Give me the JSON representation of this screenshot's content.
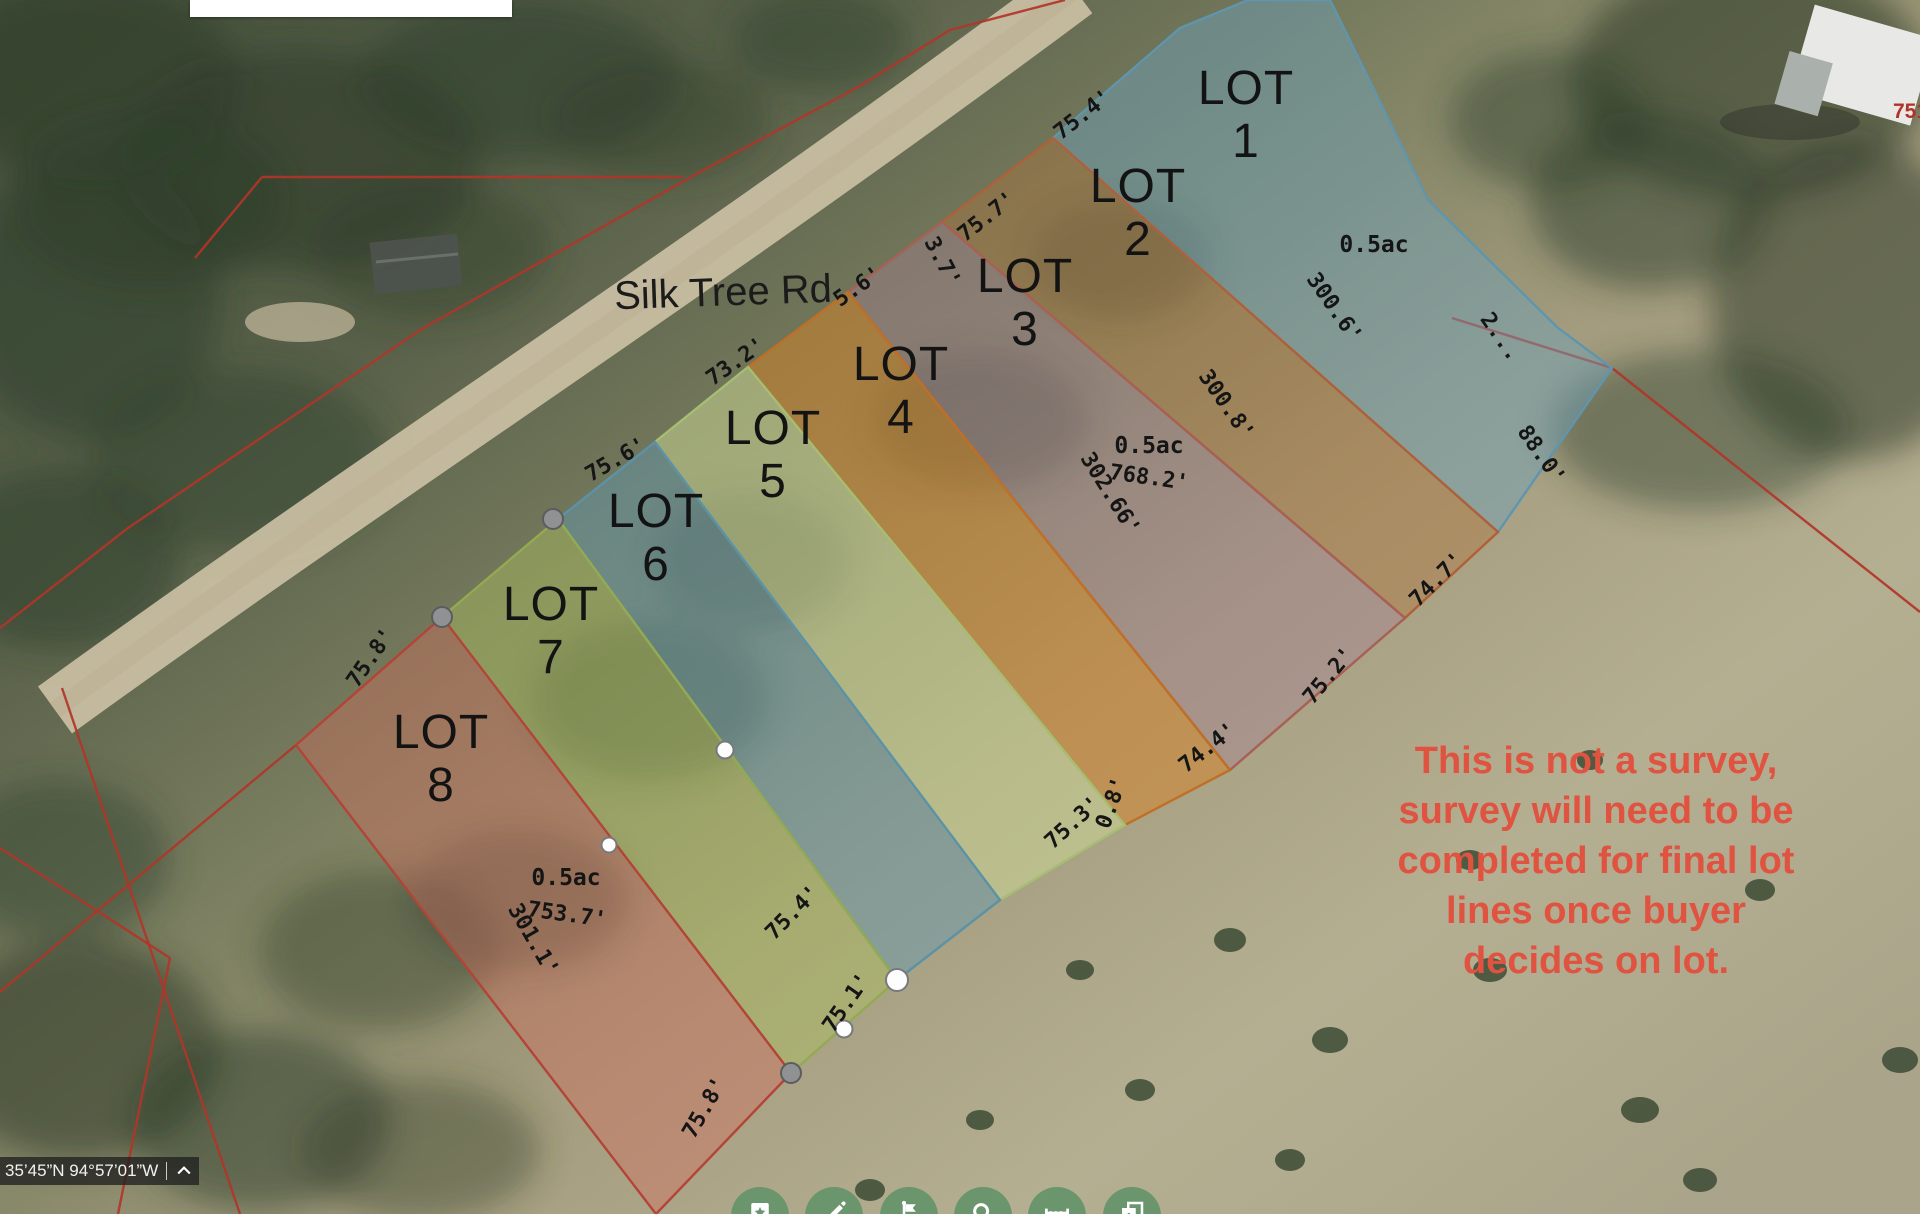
{
  "map": {
    "road_label": "Silk Tree Rd",
    "address_label": "751",
    "disclaimer": {
      "color": "#df5340",
      "lines": [
        "This is not a survey,",
        "survey will need to be",
        "completed for final lot",
        "lines once buyer",
        "decides on lot."
      ]
    },
    "lots": [
      {
        "name": "LOT",
        "number": "1",
        "area": "0.5ac",
        "label_x": 1246,
        "label_y": 62,
        "points": "1053,138 1180,28 1248,0 1330,0 1428,200 1558,328 1612,368 1498,532",
        "fill": "rgba(108,162,188,0.45)",
        "stroke": "#5f95ad"
      },
      {
        "name": "LOT",
        "number": "2",
        "label_x": 1138,
        "label_y": 160,
        "points": "1053,138 942,222 1405,618 1498,532",
        "fill": "rgba(178,115,58,0.40)",
        "stroke": "#b06038"
      },
      {
        "name": "LOT",
        "number": "3",
        "area": "0.5ac",
        "label_x": 1025,
        "label_y": 250,
        "points": "942,222 848,292 1230,770 1405,618",
        "fill": "rgba(165,125,150,0.38)",
        "stroke": "#a86055"
      },
      {
        "name": "LOT",
        "number": "4",
        "label_x": 901,
        "label_y": 338,
        "points": "848,292 748,367 1125,825 1230,770",
        "fill": "rgba(214,130,38,0.50)",
        "stroke": "#bf6f26"
      },
      {
        "name": "LOT",
        "number": "5",
        "label_x": 773,
        "label_y": 402,
        "points": "748,367 655,442 1000,900 1125,825",
        "fill": "rgba(205,218,150,0.50)",
        "stroke": "#a6bd72"
      },
      {
        "name": "LOT",
        "number": "6",
        "label_x": 656,
        "label_y": 485,
        "points": "655,442 558,519 897,980 1000,900",
        "fill": "rgba(98,152,178,0.45)",
        "stroke": "#5b92a6"
      },
      {
        "name": "LOT",
        "number": "7",
        "label_x": 551,
        "label_y": 578,
        "points": "558,519 442,617 791,1073 897,980",
        "fill": "rgba(172,192,92,0.42)",
        "stroke": "#93aa52"
      },
      {
        "name": "LOT",
        "number": "8",
        "area": "0.5ac",
        "label_x": 441,
        "label_y": 706,
        "points": "442,617 296,745 656,1214 791,1073",
        "fill": "rgba(212,108,92,0.40)",
        "stroke": "#b34437"
      }
    ],
    "dimension_labels": [
      {
        "text": "75.4'",
        "x": 1083,
        "y": 115,
        "rot": -38
      },
      {
        "text": "75.7'",
        "x": 987,
        "y": 217,
        "rot": -38
      },
      {
        "text": "3.7'",
        "x": 942,
        "y": 262,
        "rot": 62
      },
      {
        "text": "5.6'",
        "x": 858,
        "y": 287,
        "rot": -35
      },
      {
        "text": "73.2'",
        "x": 736,
        "y": 362,
        "rot": -35
      },
      {
        "text": "75.6'",
        "x": 616,
        "y": 460,
        "rot": -30
      },
      {
        "text": "75.8'",
        "x": 371,
        "y": 658,
        "rot": -55
      },
      {
        "text": "300.6'",
        "x": 1334,
        "y": 308,
        "rot": 55
      },
      {
        "text": "300.8'",
        "x": 1226,
        "y": 405,
        "rot": 55
      },
      {
        "text": "302.66'",
        "x": 1110,
        "y": 494,
        "rot": 58
      },
      {
        "text": "768.2'",
        "x": 1149,
        "y": 478,
        "rot": 8
      },
      {
        "text": "2...",
        "x": 1500,
        "y": 337,
        "rot": 55
      },
      {
        "text": "88.0'",
        "x": 1541,
        "y": 455,
        "rot": 55
      },
      {
        "text": "74.7'",
        "x": 1437,
        "y": 580,
        "rot": -45
      },
      {
        "text": "75.2'",
        "x": 1329,
        "y": 676,
        "rot": -50
      },
      {
        "text": "74.4'",
        "x": 1208,
        "y": 748,
        "rot": -38
      },
      {
        "text": "0.8'",
        "x": 1112,
        "y": 803,
        "rot": -70
      },
      {
        "text": "75.3'",
        "x": 1073,
        "y": 823,
        "rot": -42
      },
      {
        "text": "75.4'",
        "x": 793,
        "y": 913,
        "rot": -45
      },
      {
        "text": "75.1'",
        "x": 847,
        "y": 1003,
        "rot": -55
      },
      {
        "text": "75.8'",
        "x": 705,
        "y": 1108,
        "rot": -60
      },
      {
        "text": "753.7'",
        "x": 567,
        "y": 915,
        "rot": 8
      },
      {
        "text": "301.1'",
        "x": 533,
        "y": 940,
        "rot": 60
      }
    ],
    "area_labels": [
      {
        "text": "0.5ac",
        "x": 1374,
        "y": 245
      },
      {
        "text": "0.5ac",
        "x": 1149,
        "y": 446
      },
      {
        "text": "0.5ac",
        "x": 566,
        "y": 878
      }
    ],
    "boundary_lines": [
      "0,628 128,528 420,330 700,172 860,86 950,30 1065,0",
      "262,177 683,177",
      "195,258 262,177",
      "296,745 0,992",
      "62,688 240,1214",
      "0,848 170,958",
      "170,958 118,1214",
      "1612,368 1920,612",
      "1452,318 1612,368"
    ],
    "markers": [
      {
        "x": 553,
        "y": 519,
        "d": 20,
        "type": "gray"
      },
      {
        "x": 442,
        "y": 617,
        "d": 20,
        "type": "gray"
      },
      {
        "x": 791,
        "y": 1073,
        "d": 20,
        "type": "gray"
      },
      {
        "x": 897,
        "y": 980,
        "d": 22,
        "type": "white"
      },
      {
        "x": 844,
        "y": 1029,
        "d": 17,
        "type": "white"
      },
      {
        "x": 725,
        "y": 750,
        "d": 17,
        "type": "white"
      },
      {
        "x": 609,
        "y": 845,
        "d": 15,
        "type": "white"
      }
    ]
  },
  "statusbar": {
    "coordinates": "35’45”N 94°57’01”W"
  },
  "toolbar": {
    "color": "#6a956d",
    "buttons": [
      {
        "name": "bookmark-button",
        "icon": "bookmark-star-icon"
      },
      {
        "name": "draw-button",
        "icon": "pencil-icon"
      },
      {
        "name": "streetview-button",
        "icon": "flag-icon"
      },
      {
        "name": "search-button",
        "icon": "search-icon"
      },
      {
        "name": "measure-button",
        "icon": "ruler-icon"
      },
      {
        "name": "layers-button",
        "icon": "layers-icon"
      }
    ]
  }
}
